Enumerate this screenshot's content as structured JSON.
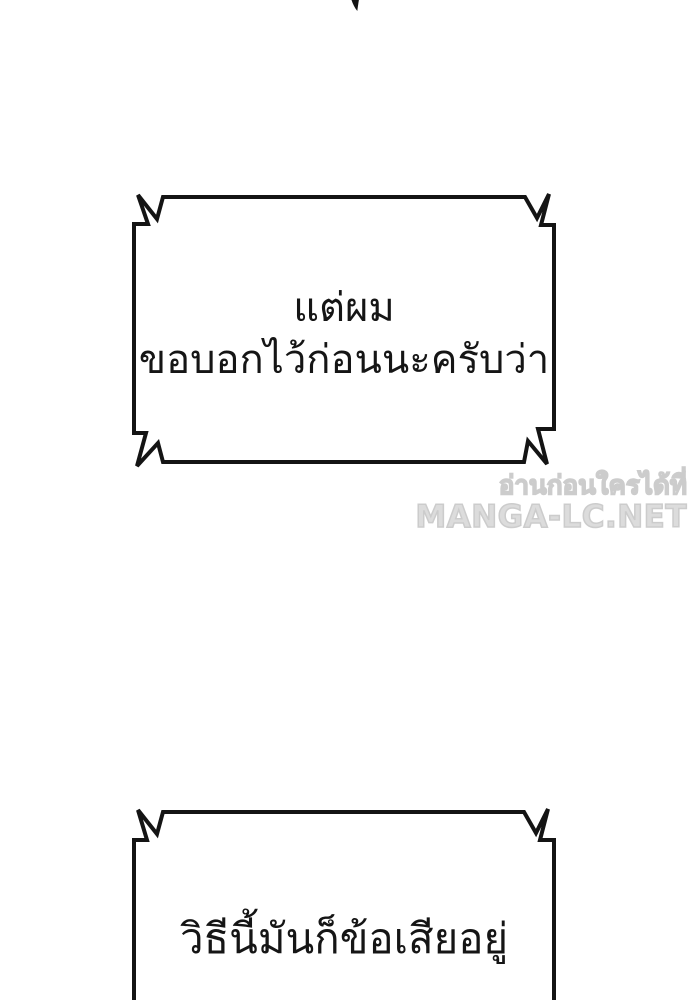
{
  "page": {
    "type": "comic-page",
    "background_color": "#ffffff",
    "ink_color": "#141414"
  },
  "speech": {
    "box1": {
      "line1": "แต่ผม",
      "line2": "ขอบอกไว้ก่อนนะครับว่า"
    },
    "box2": {
      "line1": "วิธีนี้มันก็ข้อเสียอยู่"
    }
  },
  "watermark": {
    "line1": "อ่านก่อนใครได้ที่",
    "line2": "MANGA-LC.NET",
    "color": "#d4d4d4"
  }
}
